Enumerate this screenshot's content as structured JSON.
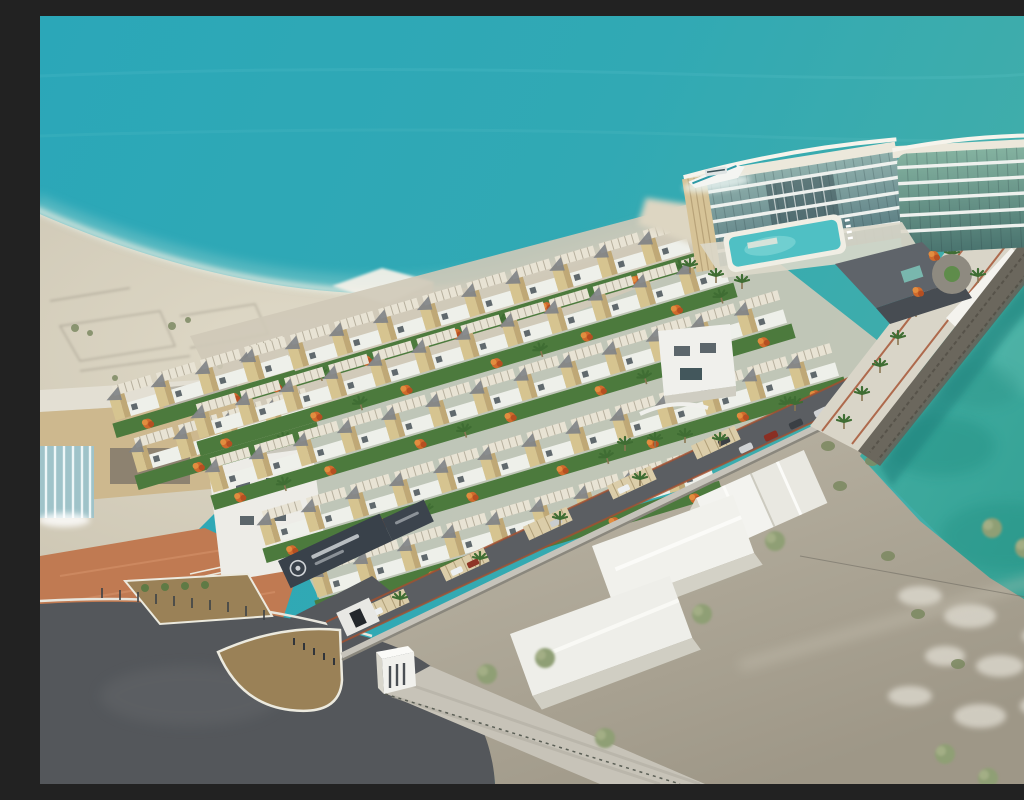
{
  "scene": {
    "title": "Aerial 3D rendering of a beachfront resort development",
    "description": "Photorealistic aerial architectural rendering: diagonal rows of beige townhouse villas with white pergola roof decks, grey shade sails, lawns and orange flame trees; a curved multi-storey glass hotel with rooftop deck, swimming pool and docked yacht on a turquoise sea at the upper right; a stone seawall promenade lined with palm trees along an emerald lagoon on the right; sandy beach with a white shade tent and traces of old foundations on the left; a dark entrance gate with an emblem sign, asphalt roads, a triangular traffic island, perimeter wall with carports, and white warehouse buildings with green trees on grey ground in the foreground.",
    "visible_text": [],
    "annotations": {
      "gate_sign": {
        "legible": false,
        "note": "small white lettering and a circular emblem on the dark entrance gate wall; too small to read"
      }
    },
    "elements": [
      "sea",
      "beach",
      "shoreline-foam",
      "beach-tent",
      "old-foundation-traces",
      "villa-rows",
      "flame-trees",
      "lawns",
      "community-building",
      "hotel",
      "hotel-pool",
      "yacht",
      "hotel-podium",
      "drop-off-roundabout",
      "promenade",
      "seawall",
      "lagoon",
      "shrubs",
      "clubhouse",
      "waterfall-feature",
      "plaza",
      "white-villa",
      "entrance-gate",
      "gatehouse",
      "perimeter-wall",
      "internal-street",
      "carports",
      "parked-cars",
      "roads",
      "traffic-island",
      "median-island",
      "paver-walkway",
      "warehouses",
      "green-trees",
      "palm-trees",
      "rubble-patches"
    ]
  },
  "colors": {
    "sea": "#2EA9B9",
    "sea_right": "#3FADAB",
    "lagoon": "#35A89B",
    "lagoon_deep": "#1F8A7E",
    "foam": "#F0EEE2",
    "sand": "#D8D2C0",
    "terrain": "#B3AC9C",
    "asphalt": "#54575B",
    "paver_walk": "#C7C3B8",
    "island_dirt": "#9A8157",
    "plaza_terracotta": "#C07A52",
    "lawn": "#4C7A3D",
    "flame_tree": "#CF6A2D",
    "palm": "#3F6D33",
    "villa_wall": "#D6C490",
    "villa_white": "#EEF0EA",
    "pergola": "#E8E3D4",
    "shade_sail": "#7E8286",
    "hotel_glass": "#6E939A",
    "hotel_band": "#EEF1EE",
    "hotel_fin": "#D6C397",
    "pool": "#4FC0C4",
    "seawall_stone": "#6B675D",
    "promenade": "#D9D5C8",
    "gate_sign": "#39414A",
    "warehouse_white": "#F2F2EE"
  }
}
